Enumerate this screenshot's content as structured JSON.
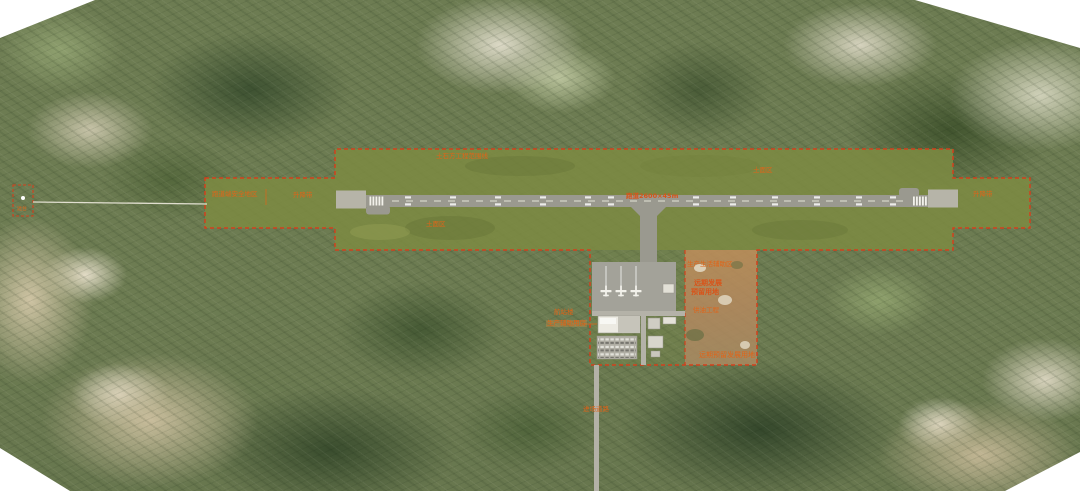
{
  "map": {
    "kind": "airport-master-plan-over-satellite",
    "colors": {
      "boundary_dashed": "#d2401c",
      "label_orange": "#e06418",
      "graded_area_olive": "#7c8a42",
      "runway_grey": "#9a998f",
      "cleared_earth": "#b98a5e"
    },
    "plan_labels": {
      "earthwork_boundary": "土石方工程范围线",
      "soil_area_top": "土面区",
      "soil_area_left": "土面区",
      "resa_left": "跑道端安全地区",
      "strip_left": "升降带",
      "strip_right": "升降带",
      "runway": "跑道2600×45m",
      "aux_area": "生产生活辅助区",
      "future_line1": "远期发展",
      "future_line2": "预留用地",
      "fuel": "供油工程",
      "future_reserve": "远期预留发展用地",
      "terminal": "航站楼",
      "support": "生产辅助用房",
      "access_road": "进场道路",
      "navaid": "远台"
    }
  }
}
